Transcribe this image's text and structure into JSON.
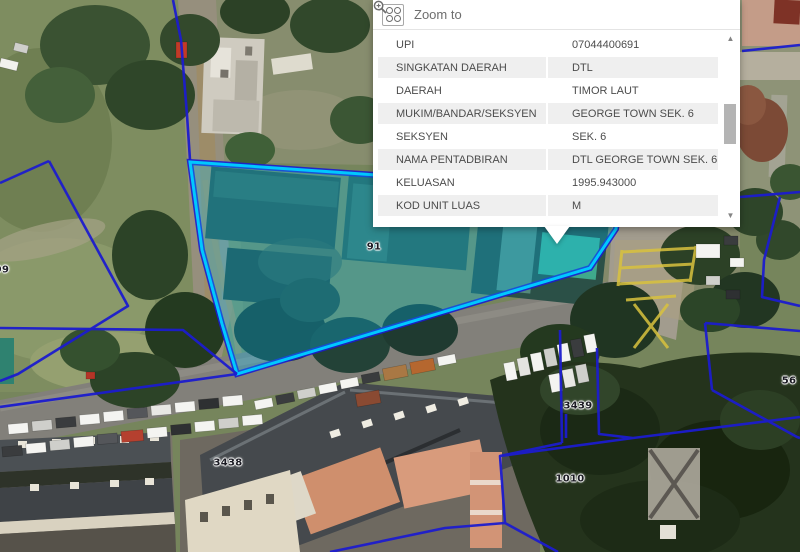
{
  "popup": {
    "header": {
      "zoom_to_label": "Zoom to"
    },
    "scrollbar": {
      "up_glyph": "▲",
      "down_glyph": "▼"
    },
    "rows": [
      {
        "label": "UPI",
        "value": "07044400691"
      },
      {
        "label": "SINGKATAN DAERAH",
        "value": "DTL"
      },
      {
        "label": "DAERAH",
        "value": "TIMOR LAUT"
      },
      {
        "label": "MUKIM/BANDAR/SEKSYEN",
        "value": "GEORGE TOWN SEK. 6"
      },
      {
        "label": "SEKSYEN",
        "value": "SEK. 6"
      },
      {
        "label": "NAMA PENTADBIRAN",
        "value": "DTL GEORGE TOWN SEK. 6"
      },
      {
        "label": "KELUASAN",
        "value": "1995.943000"
      },
      {
        "label": "KOD UNIT LUAS",
        "value": "M"
      }
    ]
  },
  "map": {
    "parcel_labels": [
      {
        "text": "91"
      },
      {
        "text": "3438"
      },
      {
        "text": "3439"
      },
      {
        "text": "1010"
      },
      {
        "text": "56"
      },
      {
        "text": "99"
      }
    ],
    "colors": {
      "selection": "#00C8FF",
      "boundary": "#1C1CCE"
    }
  }
}
